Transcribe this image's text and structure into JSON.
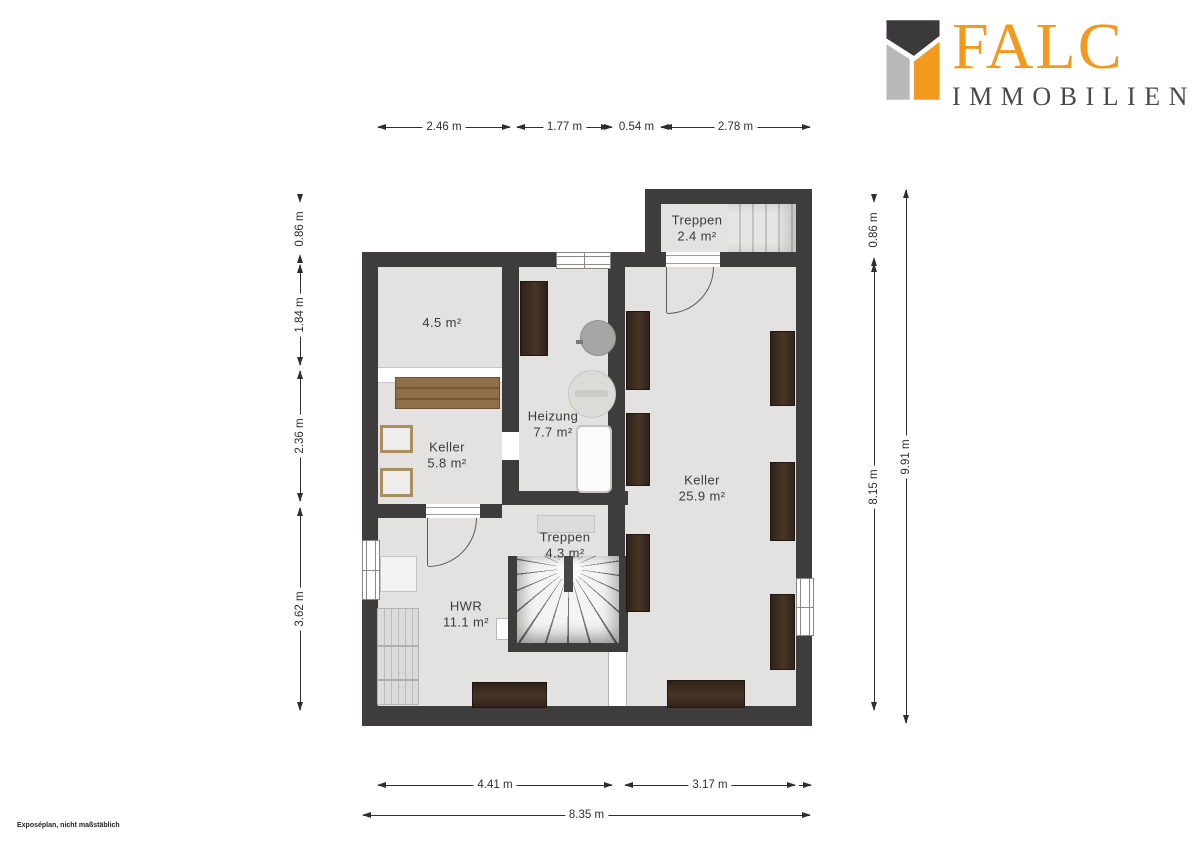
{
  "logo": {
    "brand": "FALC",
    "subtitle": "IMMOBILIEN",
    "colors": {
      "orange": "#F29A1E",
      "dark": "#3B393B",
      "gray": "#B9B8BA",
      "text": "#49484B"
    }
  },
  "footnote": "Exposéplan, nicht maßstäblich",
  "rooms": {
    "treppen_og": {
      "name": "Treppen",
      "area": "2.4 m²"
    },
    "abstell": {
      "area": "4.5 m²"
    },
    "heizung": {
      "name": "Heizung",
      "area": "7.7 m²"
    },
    "keller_klein": {
      "name": "Keller",
      "area": "5.8 m²"
    },
    "keller_gross": {
      "name": "Keller",
      "area": "25.9 m²"
    },
    "treppen_ug": {
      "name": "Treppen",
      "area": "4.3 m²"
    },
    "hwr": {
      "name": "HWR",
      "area": "11.1 m²"
    }
  },
  "dimensions": {
    "top": [
      "2.46 m",
      "1.77 m",
      "0.54 m",
      "2.78 m"
    ],
    "left": [
      "0.86 m",
      "1.84 m",
      "2.36 m",
      "3.62 m"
    ],
    "right_inner": [
      "0.86 m",
      "8.15 m"
    ],
    "right_outer": [
      "9.91 m"
    ],
    "bottom": [
      "4.41 m",
      "3.17 m"
    ],
    "total_width": "8.35 m"
  },
  "colors": {
    "wall": "#3F3C3E",
    "floor": "#E3E2E0",
    "furniture_dark": "#3C2C21",
    "wood": "#8A6C47",
    "dim_text": "#2E2E2E",
    "logo_orange": "#F29A1E"
  }
}
